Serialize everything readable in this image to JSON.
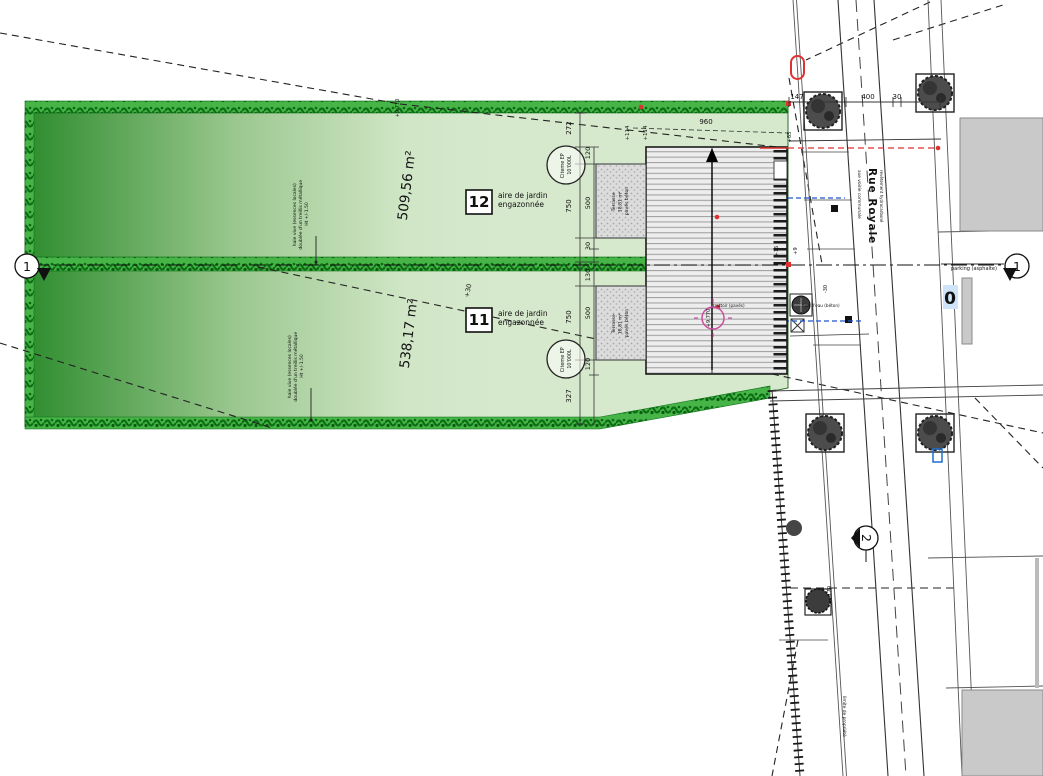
{
  "plan": {
    "parcels": [
      {
        "id": "12",
        "area": "509,56 m²",
        "garden_line1": "aire de jardin",
        "garden_line2": "engazonnée"
      },
      {
        "id": "11",
        "area": "538,17 m²",
        "garden_line1": "aire de jardin",
        "garden_line2": "engazonnée"
      }
    ],
    "cistern": {
      "line1": "Citerne EP",
      "line2": "10'000L"
    },
    "terrace": {
      "line1": "Terrasse",
      "line2": "18,81 m²",
      "line3": "pavés béton"
    },
    "hedge_note": {
      "line1": "haie vive (essences locales)",
      "line2": "doublée d'un treillis métallique",
      "line3": "Ht +/-1.50"
    },
    "dims": {
      "outer": [
        "272",
        "750",
        "750",
        "327"
      ],
      "inner": [
        "120",
        "500",
        "30",
        "130",
        "500",
        "120"
      ],
      "plus114a": "+114",
      "plus114b": "+114",
      "d960": "960",
      "road": [
        "147",
        "400",
        "30"
      ]
    },
    "levels": {
      "p65": "+65",
      "p16": "+16",
      "p9": "+9",
      "m30": "-30",
      "m170": "-170",
      "p30": "+30",
      "alt": "+9.770",
      "alt2": "+9.770"
    },
    "road": {
      "name": "Rue Royale",
      "axis_label": "axe voirie communale",
      "surface_label": "revêtement hydrocarboné",
      "parking_label": "parking (asphalte)",
      "boundary_label": "limite de propriété",
      "paving_label": "trottoir (pavés)",
      "gutter_label": "filet d'eau (béton)"
    },
    "sections": {
      "s1": "1",
      "s1b": "1",
      "s2": "2"
    },
    "markers": {
      "zero_blue": "0"
    },
    "colors": {
      "accent_red": "#e03131",
      "accent_blue": "#1d6fd1",
      "accent_magenta": "#cc4d9e",
      "parcel_dark": "#2d8c2d",
      "parcel_light": "#d6e9cd",
      "hedge": "#14861c"
    }
  }
}
